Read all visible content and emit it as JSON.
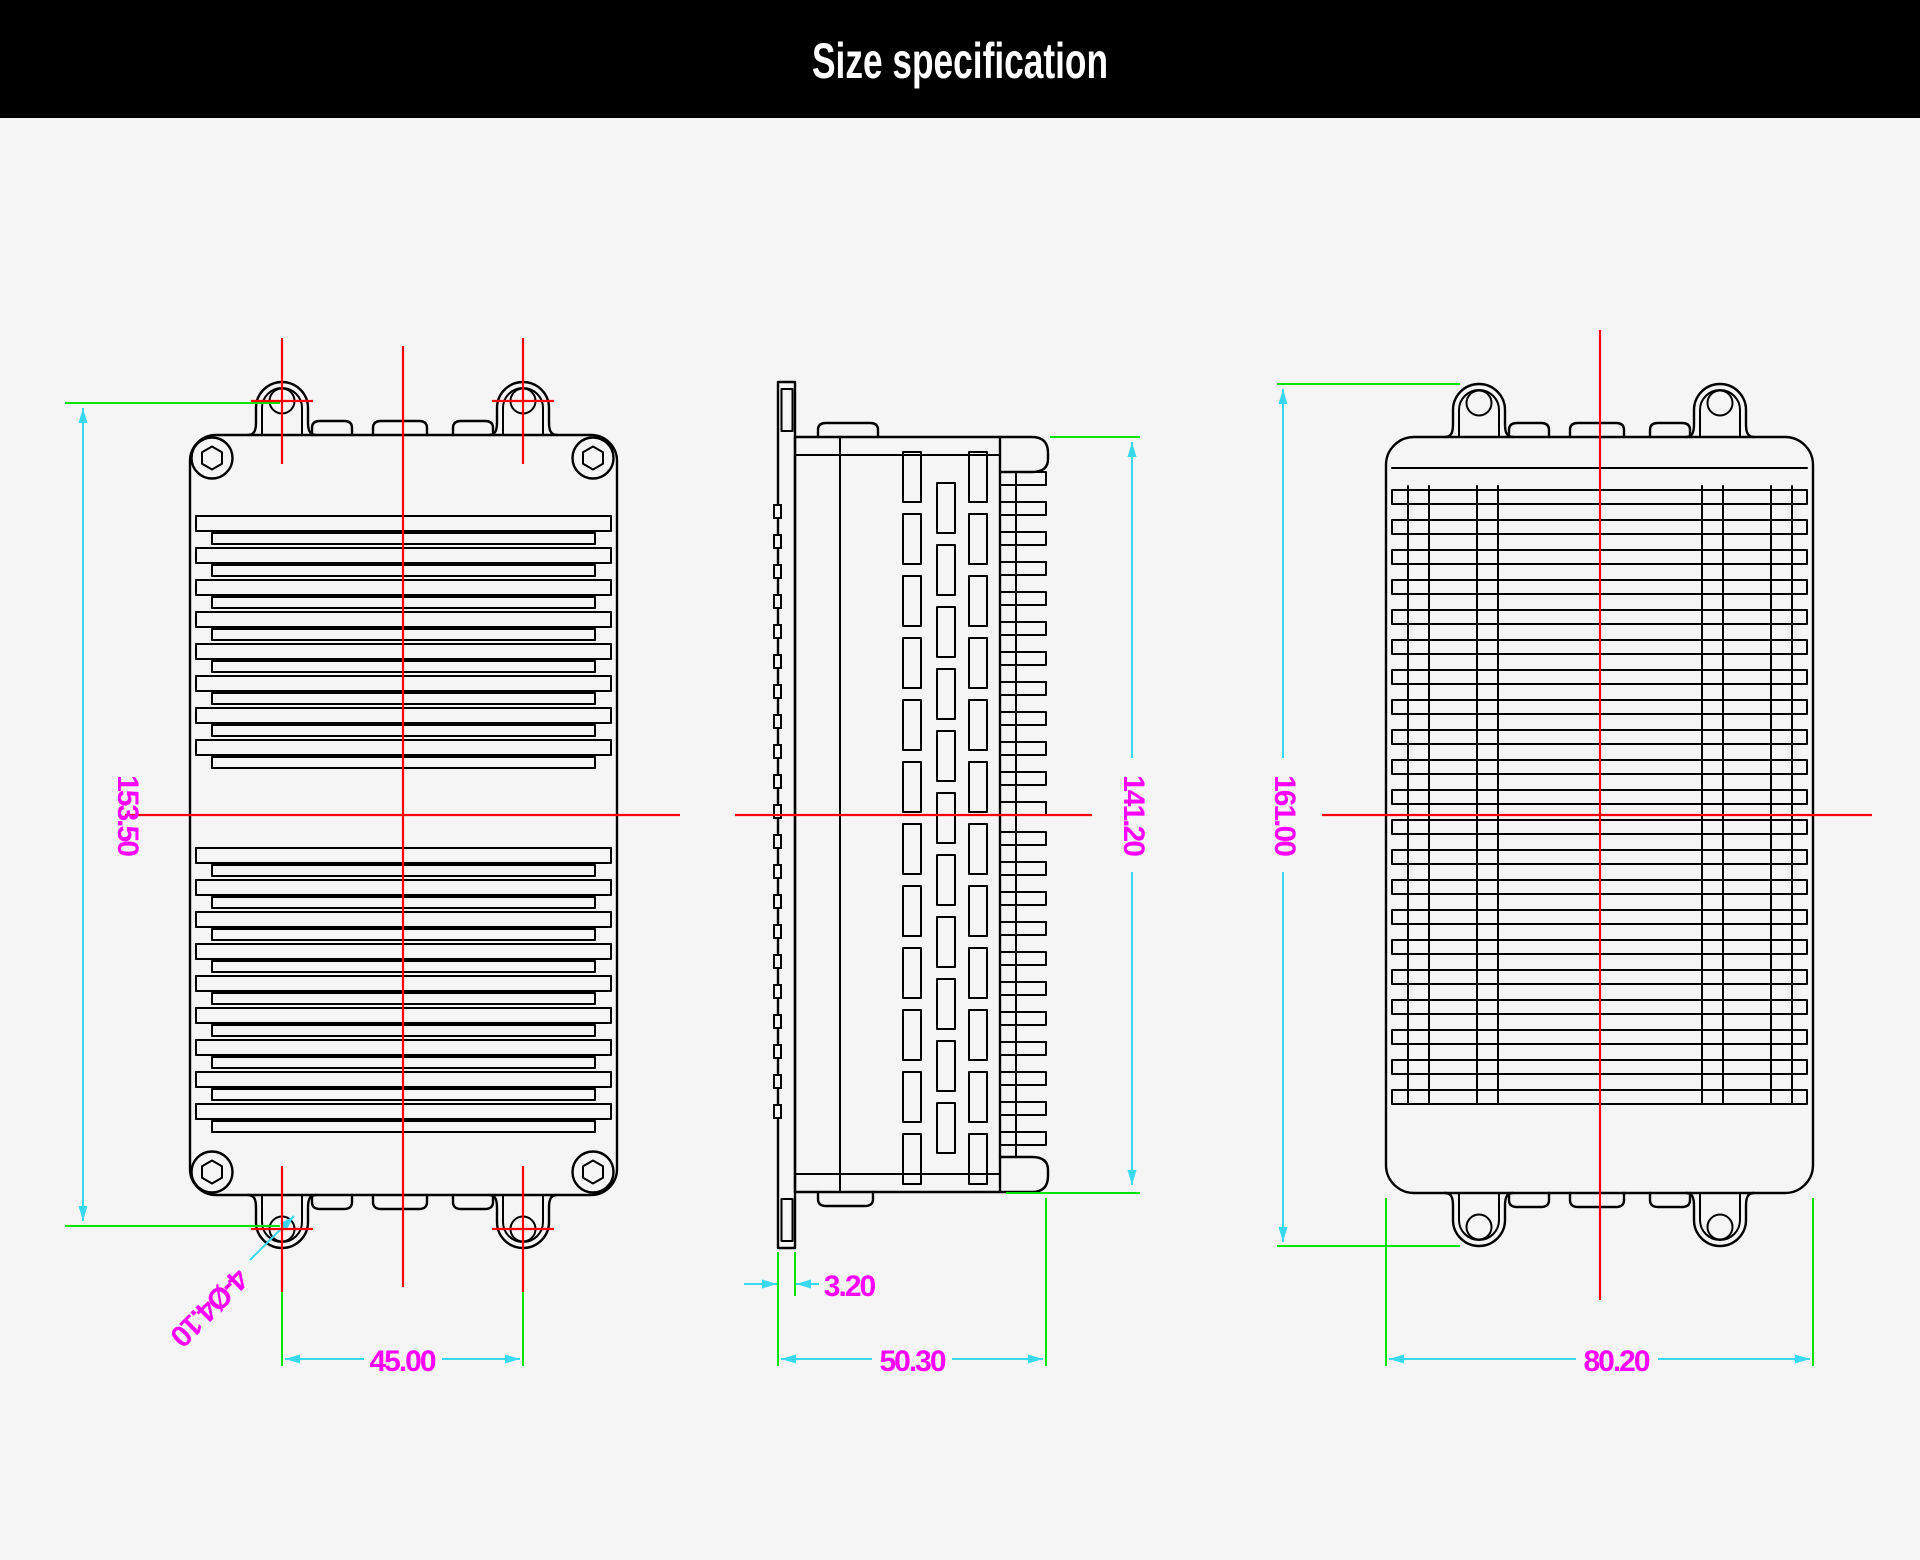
{
  "header": {
    "title": "Size specification"
  },
  "dims": {
    "front_height": "153.50",
    "front_hole_spacing": "45.00",
    "front_hole_callout": "4-Ø4.10",
    "side_height": "141.20",
    "side_flange_thickness": "3.20",
    "side_depth": "50.30",
    "back_height": "161.00",
    "back_width": "80.20"
  },
  "colors": {
    "background": "#f5f5f6",
    "header_background": "#000000",
    "header_text": "#ffffff",
    "outline": "#000000",
    "centerline_red": "#ff0000",
    "extension_green": "#00e400",
    "dimension_cyan": "#38d9f0",
    "dimension_text_magenta": "#ff00ff"
  }
}
